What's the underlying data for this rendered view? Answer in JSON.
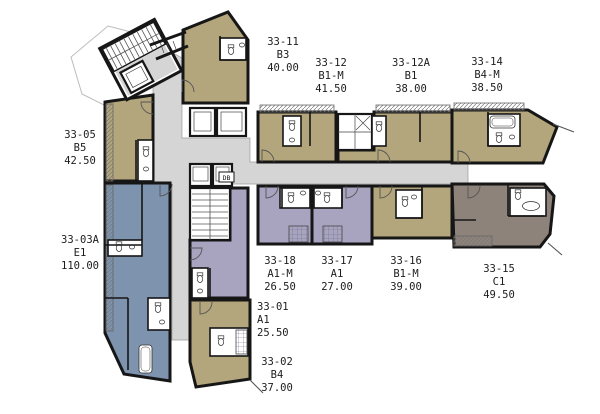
{
  "palette": {
    "unit_tan": "#b3a67c",
    "unit_lavender": "#a8a4c0",
    "unit_blue": "#7d93ae",
    "unit_taupe": "#8e837b",
    "corridor": "#d5d5d5",
    "wall": "#161616",
    "background": "#ffffff"
  },
  "core": {
    "db_label": "DB"
  },
  "units": [
    {
      "id": "33-05",
      "type": "B5",
      "area": "42.50"
    },
    {
      "id": "33-03A",
      "type": "E1",
      "area": "110.00"
    },
    {
      "id": "33-11",
      "type": "B3",
      "area": "40.00"
    },
    {
      "id": "33-12",
      "type": "B1-M",
      "area": "41.50"
    },
    {
      "id": "33-12A",
      "type": "B1",
      "area": "38.00"
    },
    {
      "id": "33-14",
      "type": "B4-M",
      "area": "38.50"
    },
    {
      "id": "33-18",
      "type": "A1-M",
      "area": "26.50"
    },
    {
      "id": "33-17",
      "type": "A1",
      "area": "27.00"
    },
    {
      "id": "33-16",
      "type": "B1-M",
      "area": "39.00"
    },
    {
      "id": "33-15",
      "type": "C1",
      "area": "49.50"
    },
    {
      "id": "33-01",
      "type": "A1",
      "area": "25.50"
    },
    {
      "id": "33-02",
      "type": "B4",
      "area": "37.00"
    }
  ]
}
